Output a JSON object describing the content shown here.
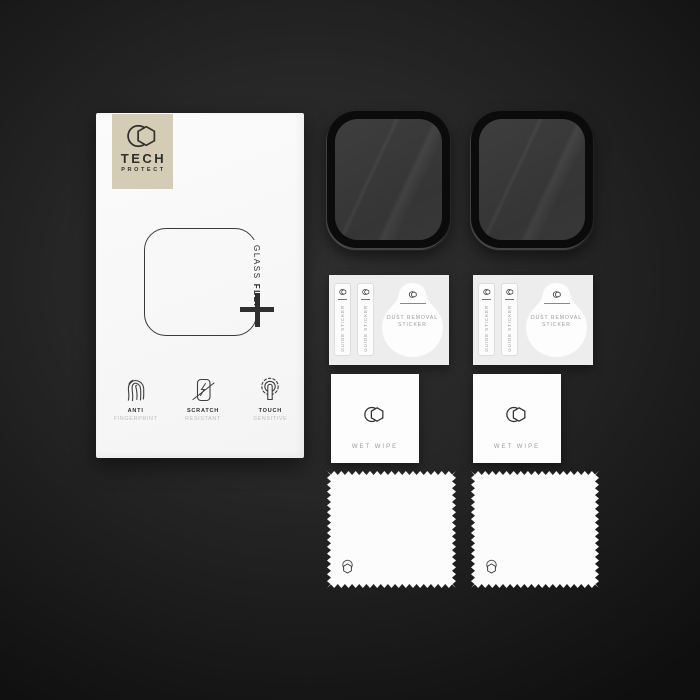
{
  "brand": {
    "line1": "TECH",
    "line2": "PROTECT"
  },
  "package_box": {
    "product_name_regular": "GLASS",
    "product_name_bold": "FLEX",
    "features": [
      {
        "title": "ANTI",
        "subtitle": "FINGERPRINT",
        "icon": "fingerprint-icon"
      },
      {
        "title": "SCRATCH",
        "subtitle": "RESISTANT",
        "icon": "scratch-icon"
      },
      {
        "title": "TOUCH",
        "subtitle": "SENSITIVE",
        "icon": "touch-icon"
      }
    ]
  },
  "sticker_sheets": {
    "guide_sticker_label": "GUIDE STICKER",
    "dust_removal_line1": "DUST REMOVAL",
    "dust_removal_line2": "STICKER"
  },
  "wet_wipes": {
    "label": "WET WIPE"
  },
  "visible_items": {
    "screen_protectors": 2,
    "sticker_sheets": 2,
    "wet_wipes": 2,
    "microfiber_cloths": 2
  },
  "colors": {
    "background_center": "#2f2f2f",
    "background_edge": "#0f0f0f",
    "badge_beige": "#d4ccb5",
    "box_white": "#f8f8f8",
    "sticker_card_gray": "#ededed",
    "protector_frame": "#0b0b0b",
    "protector_glass": "#383838"
  }
}
